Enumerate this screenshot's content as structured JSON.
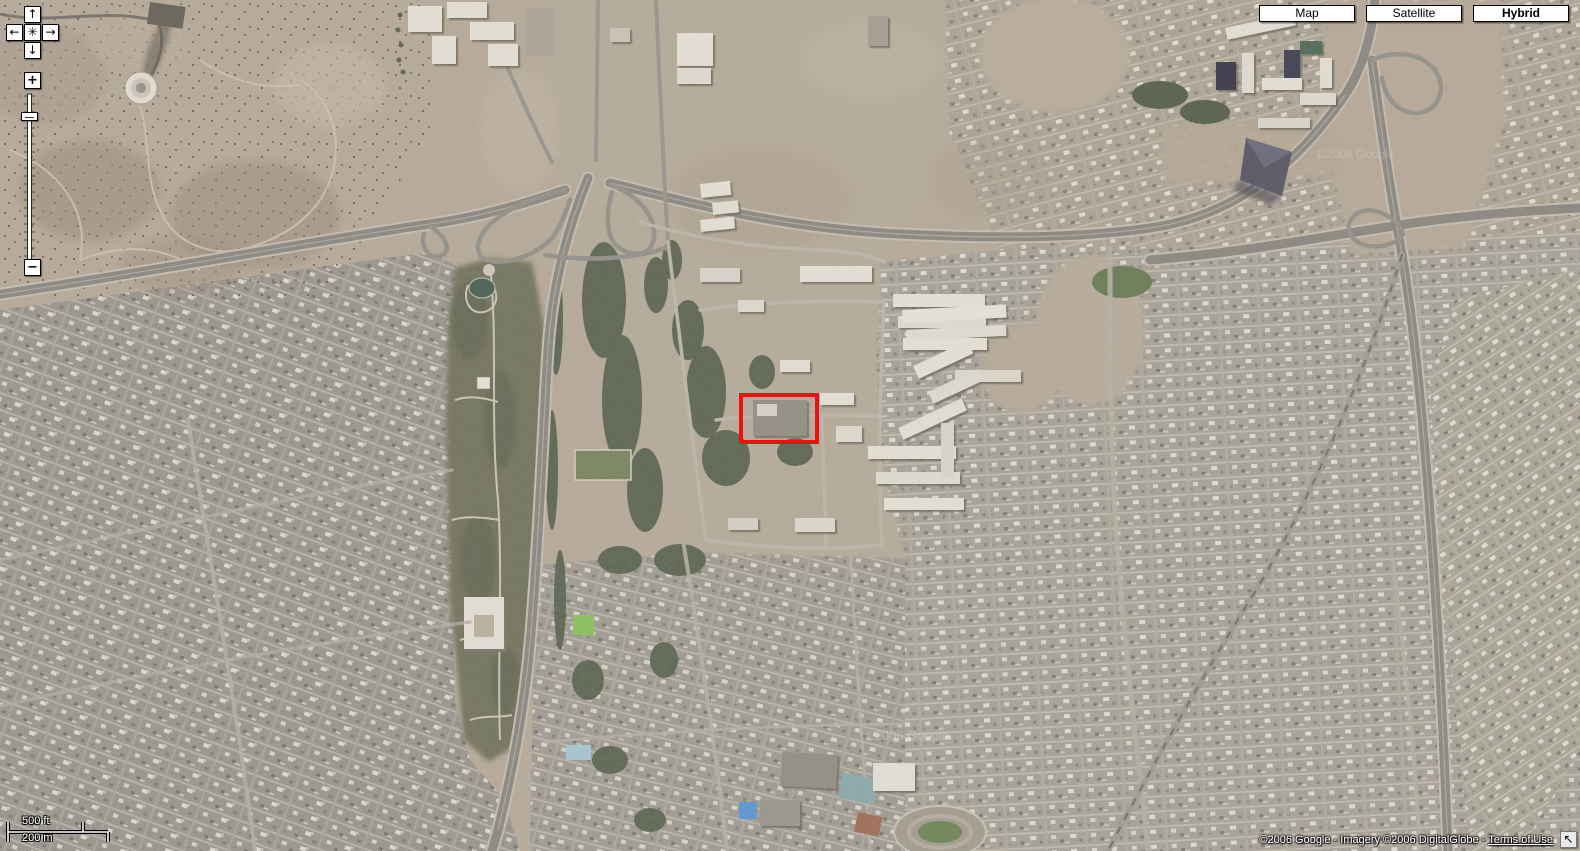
{
  "map_type_control": {
    "buttons": [
      {
        "label": "Map",
        "active": false
      },
      {
        "label": "Satellite",
        "active": false
      },
      {
        "label": "Hybrid",
        "active": true
      }
    ]
  },
  "navigation_control": {
    "pan_up_icon": "↑",
    "pan_down_icon": "↓",
    "pan_left_icon": "←",
    "pan_right_icon": "→",
    "return_to_last_result_icon": "✳",
    "zoom_in_label": "+",
    "zoom_out_label": "−"
  },
  "scale_bar": {
    "imperial_label": "500 ft",
    "metric_label": "200 m"
  },
  "attribution": {
    "copyright_text": "©2006 Google - Imagery ©2006 DigitalGlobe - ",
    "terms_link_label": "Terms of Use",
    "overview_arrow_icon": "↖"
  },
  "imagery_watermark": "©2006 Google",
  "annotation": {
    "highlight_color": "#ee1010"
  }
}
